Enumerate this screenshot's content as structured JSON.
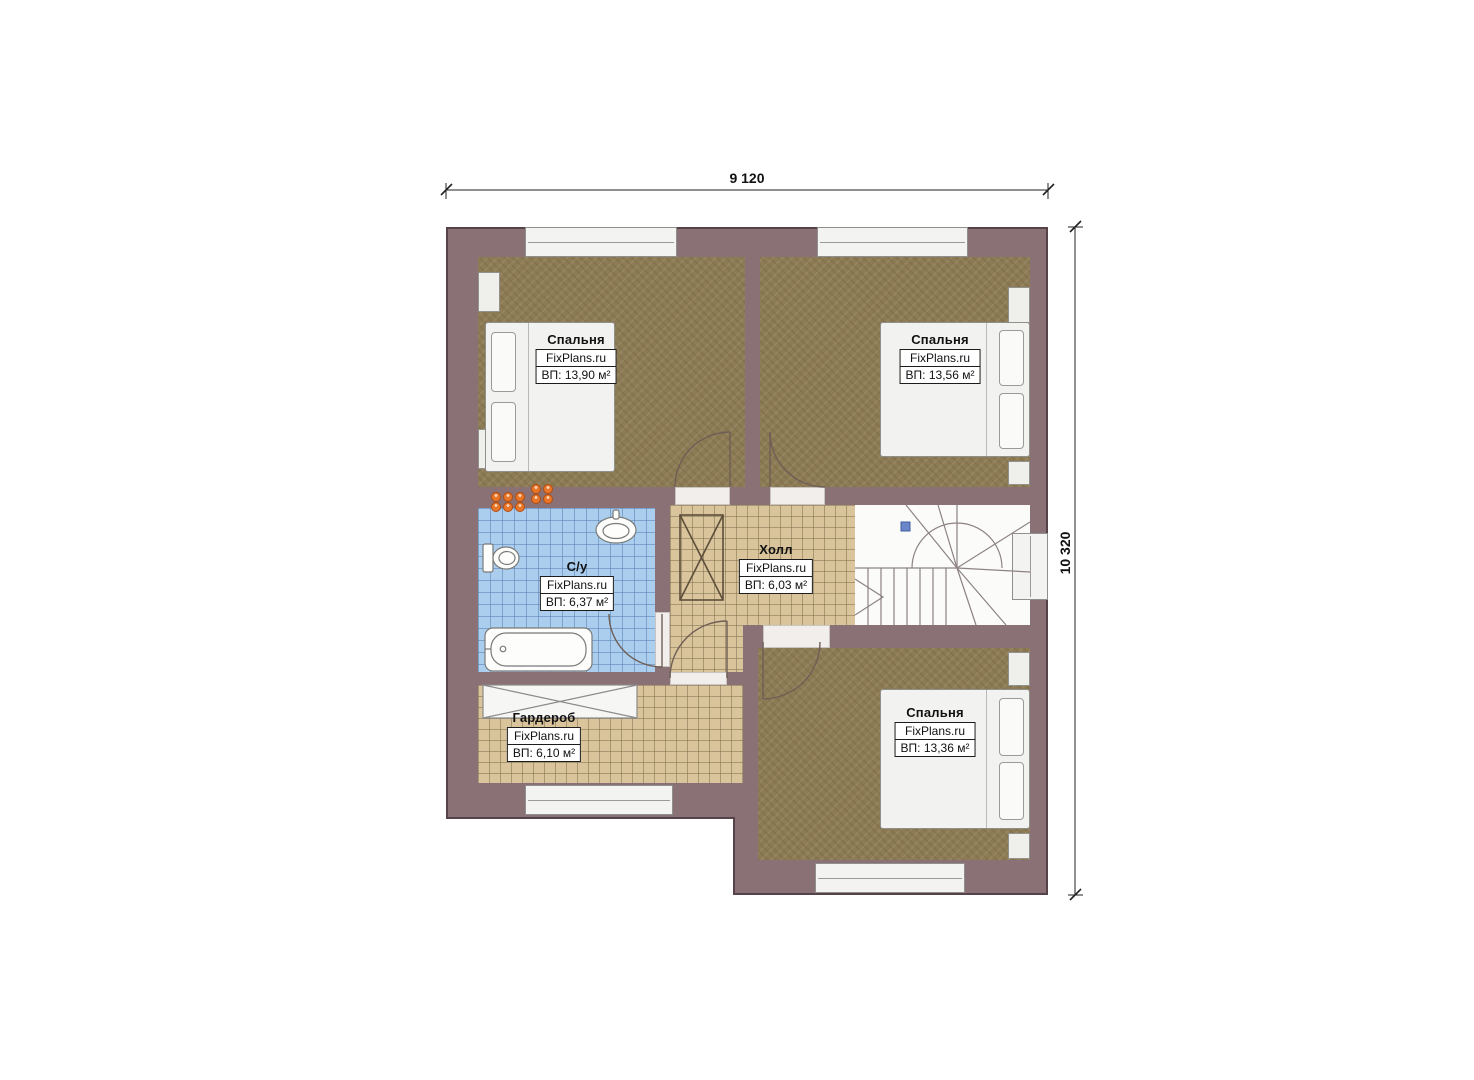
{
  "plan_title": "Floor plan (2nd floor)",
  "dimensions": {
    "width_label": "9 120",
    "height_label": "10 320"
  },
  "rooms": [
    {
      "id": "bedroom-top-left",
      "name": "Спальня",
      "brand": "FixPlans.ru",
      "area": "ВП: 13,90 м²"
    },
    {
      "id": "bedroom-top-right",
      "name": "Спальня",
      "brand": "FixPlans.ru",
      "area": "ВП: 13,56 м²"
    },
    {
      "id": "bathroom",
      "name": "С/у",
      "brand": "FixPlans.ru",
      "area": "ВП: 6,37 м²"
    },
    {
      "id": "hall",
      "name": "Холл",
      "brand": "FixPlans.ru",
      "area": "ВП: 6,03 м²"
    },
    {
      "id": "wardrobe",
      "name": "Гардероб",
      "brand": "FixPlans.ru",
      "area": "ВП: 6,10 м²"
    },
    {
      "id": "bedroom-bottom-right",
      "name": "Спальня",
      "brand": "FixPlans.ru",
      "area": "ВП: 13,36 м²"
    }
  ],
  "colors": {
    "wall": "#8a7175",
    "wall_outline": "#554349",
    "carpet_brown": "#8d7b55",
    "tile_tan": "#d9c49c",
    "tile_blue": "#abceef",
    "riser_orange": "#e8762a",
    "stairs_marker_blue": "#6b86c8"
  }
}
